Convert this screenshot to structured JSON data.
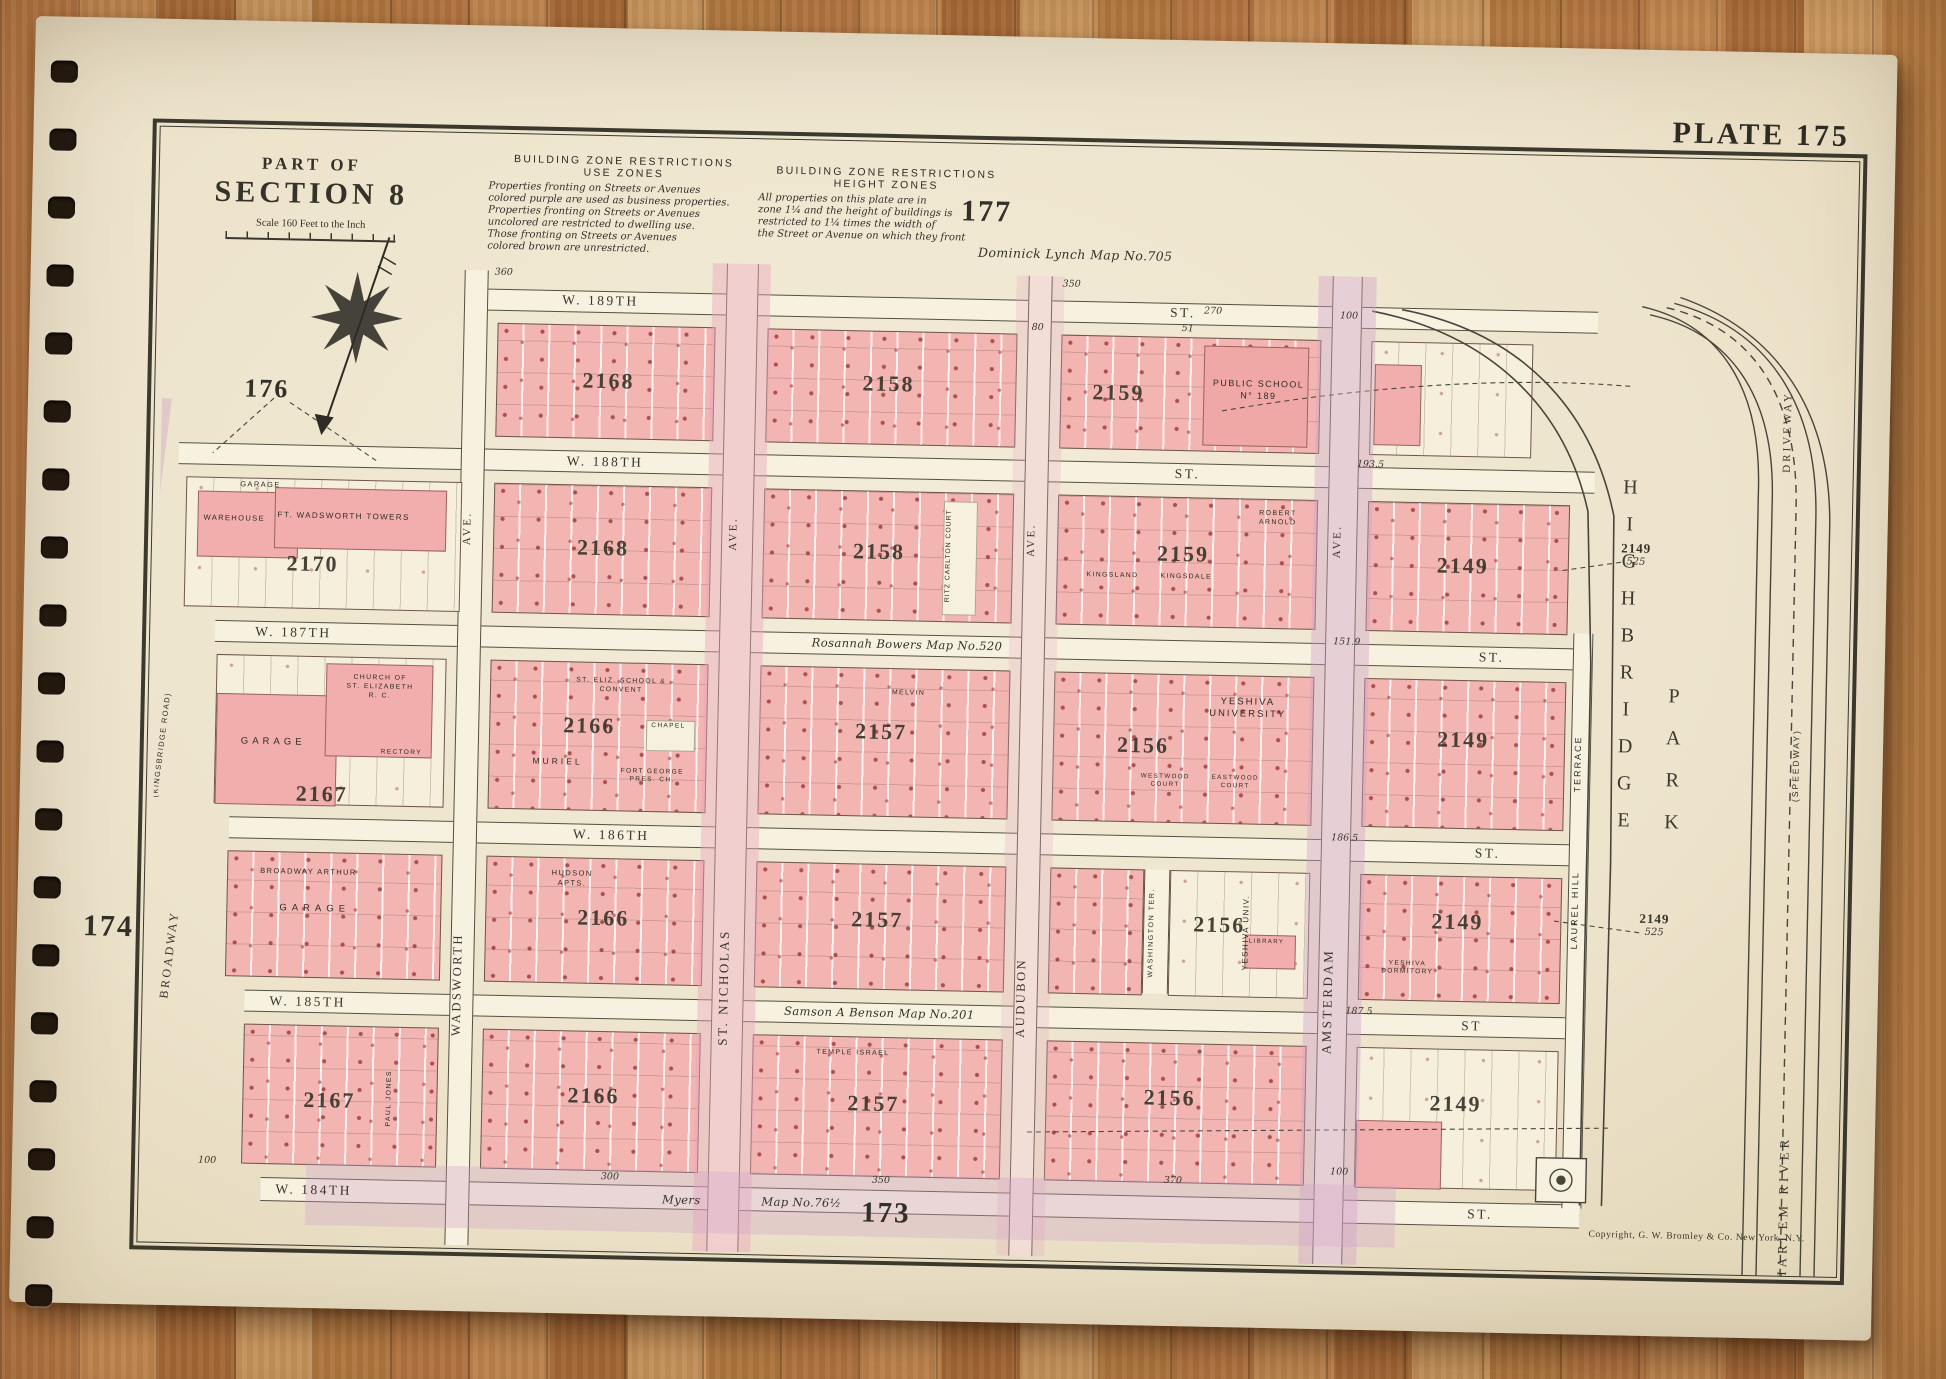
{
  "plate": {
    "label": "PLATE 175",
    "copyright": "Copyright, G. W. Bromley & Co. New York, N.Y."
  },
  "header": {
    "part_of": "PART OF",
    "section": "SECTION 8",
    "scale": "Scale 160 Feet to the Inch"
  },
  "zone_notes": {
    "use_title": "BUILDING ZONE RESTRICTIONS",
    "use_subtitle": "USE ZONES",
    "use_body": "Properties fronting on Streets or Avenues\ncolored purple are used as business properties.\nProperties fronting on Streets or Avenues\nuncolored are restricted to dwelling use.\nThose fronting on Streets or Avenues\ncolored brown are unrestricted.",
    "height_title": "BUILDING ZONE RESTRICTIONS",
    "height_subtitle": "HEIGHT  ZONES",
    "height_body": "All properties on this plate are in\nzone 1¼ and the height of buildings is\nrestricted to 1¼ times the width of\nthe Street or Avenue on which they front"
  },
  "adjacent_plates": {
    "top": "177",
    "left_upper": "176",
    "left_lower": "174",
    "bottom": "173"
  },
  "map_notes": {
    "lynch": "Dominick Lynch Map No.705",
    "bowers": "Rosannah Bowers Map No.520",
    "benson": "Samson A Benson Map No.201",
    "myers": "Myers",
    "map76": "Map No.76½"
  },
  "streets": {
    "w189": {
      "name": "W. 189TH",
      "st": "ST."
    },
    "w188": {
      "name": "W. 188TH",
      "st": "ST."
    },
    "w187": {
      "name": "W. 187TH",
      "st": "ST."
    },
    "w186": {
      "name": "W. 186TH",
      "st": "ST."
    },
    "w185": {
      "name": "W. 185TH",
      "st": "ST"
    },
    "w184": {
      "name": "W. 184TH",
      "st": "ST."
    }
  },
  "avenues": {
    "wadsworth": {
      "ave": "AVE.",
      "name": "WADSWORTH"
    },
    "st_nicholas": {
      "ave": "AVE.",
      "name": "ST. NICHOLAS"
    },
    "audubon": {
      "ave": "AVE.",
      "name": "AUDUBON"
    },
    "amsterdam": {
      "ave": "AVE.",
      "name": "AMSTERDAM"
    },
    "laurel_hill": {
      "upper": "TERRACE",
      "lower": "LAUREL HILL"
    },
    "washington": {
      "name": "WASHINGTON TER."
    },
    "broadway": {
      "name": "BROADWAY",
      "sub": "(KINGSBRIDGE ROAD)"
    }
  },
  "park": {
    "highbridge": "HIGHBRIDGE",
    "park": "PARK",
    "harlem_river": "HARLEM RIVER",
    "driveway": "DRIVEWAY",
    "speedway": "(SPEEDWAY)"
  },
  "blocks": {
    "b1": {
      "num": "2168"
    },
    "c1": {
      "num": "2158"
    },
    "d1": {
      "num": "2159",
      "school": "PUBLIC SCHOOL\nN° 189"
    },
    "e2": {
      "num": "2149"
    },
    "a2": {
      "num": "2170",
      "garage": "GARAGE",
      "warehouse": "WAREHOUSE",
      "towers": "FT. WADSWORTH  TOWERS"
    },
    "b2": {
      "num": "2168"
    },
    "c2": {
      "num": "2158",
      "ritz": "RITZ CARLTON COURT"
    },
    "d2": {
      "num": "2159",
      "kingsland": "KINGSLAND",
      "kingsdale": "KINGSDALE",
      "robert": "ROBERT\nARNOLD"
    },
    "a3": {
      "num": "2167",
      "garage": "GARAGE",
      "church": "CHURCH OF\nST. ELIZABETH\nR. C.",
      "rectory": "RECTORY"
    },
    "b3": {
      "num": "2166",
      "convent": "ST. ELIZ. SCHOOL &\nCONVENT",
      "chapel": "CHAPEL",
      "muriel": "MURIEL",
      "fort_george": "FORT GEORGE\nPRES. CH."
    },
    "c3": {
      "num": "2157",
      "melvin": "MELVIN"
    },
    "d3": {
      "num": "2156",
      "yeshiva": "YESHIVA\nUNIVERSITY",
      "westwood": "WESTWOOD\nCOURT",
      "eastwood": "EASTWOOD\nCOURT"
    },
    "e3": {
      "num": "2149"
    },
    "a4": {
      "name": "BROADWAY ARTHUR",
      "garage": "GARAGE"
    },
    "b4": {
      "num": "2166",
      "hudson": "HUDSON\nAPTS."
    },
    "c4": {
      "num": "2157"
    },
    "d4": {
      "num": "2156",
      "univ": "YESHIVA UNIV.",
      "library": "LIBRARY"
    },
    "e4": {
      "num": "2149",
      "dorm": "YESHIVA\nDORMITORY"
    },
    "a5": {
      "num": "2167",
      "paul_jones": "PAUL JONES"
    },
    "b5": {
      "num": "2166"
    },
    "c5": {
      "num": "2157",
      "temple": "TEMPLE ISRAEL"
    },
    "d5": {
      "num": "2156"
    },
    "e5": {
      "num": "2149"
    }
  },
  "margin_refs": {
    "upper": {
      "num": "2149",
      "sub": "525"
    },
    "lower": {
      "num": "2149",
      "sub": "525"
    }
  },
  "dims": {
    "d360": "360",
    "d350": "350",
    "d270": "270",
    "d51": "51",
    "d100": "100",
    "d80": "80",
    "d193": "193.5",
    "d151": "151.9",
    "d186": "186.5",
    "d187": "187.5",
    "d300": "300",
    "d350b": "350",
    "d370": "370",
    "d100b": "100",
    "d100c": "100"
  },
  "binding": {
    "holes": 19
  }
}
